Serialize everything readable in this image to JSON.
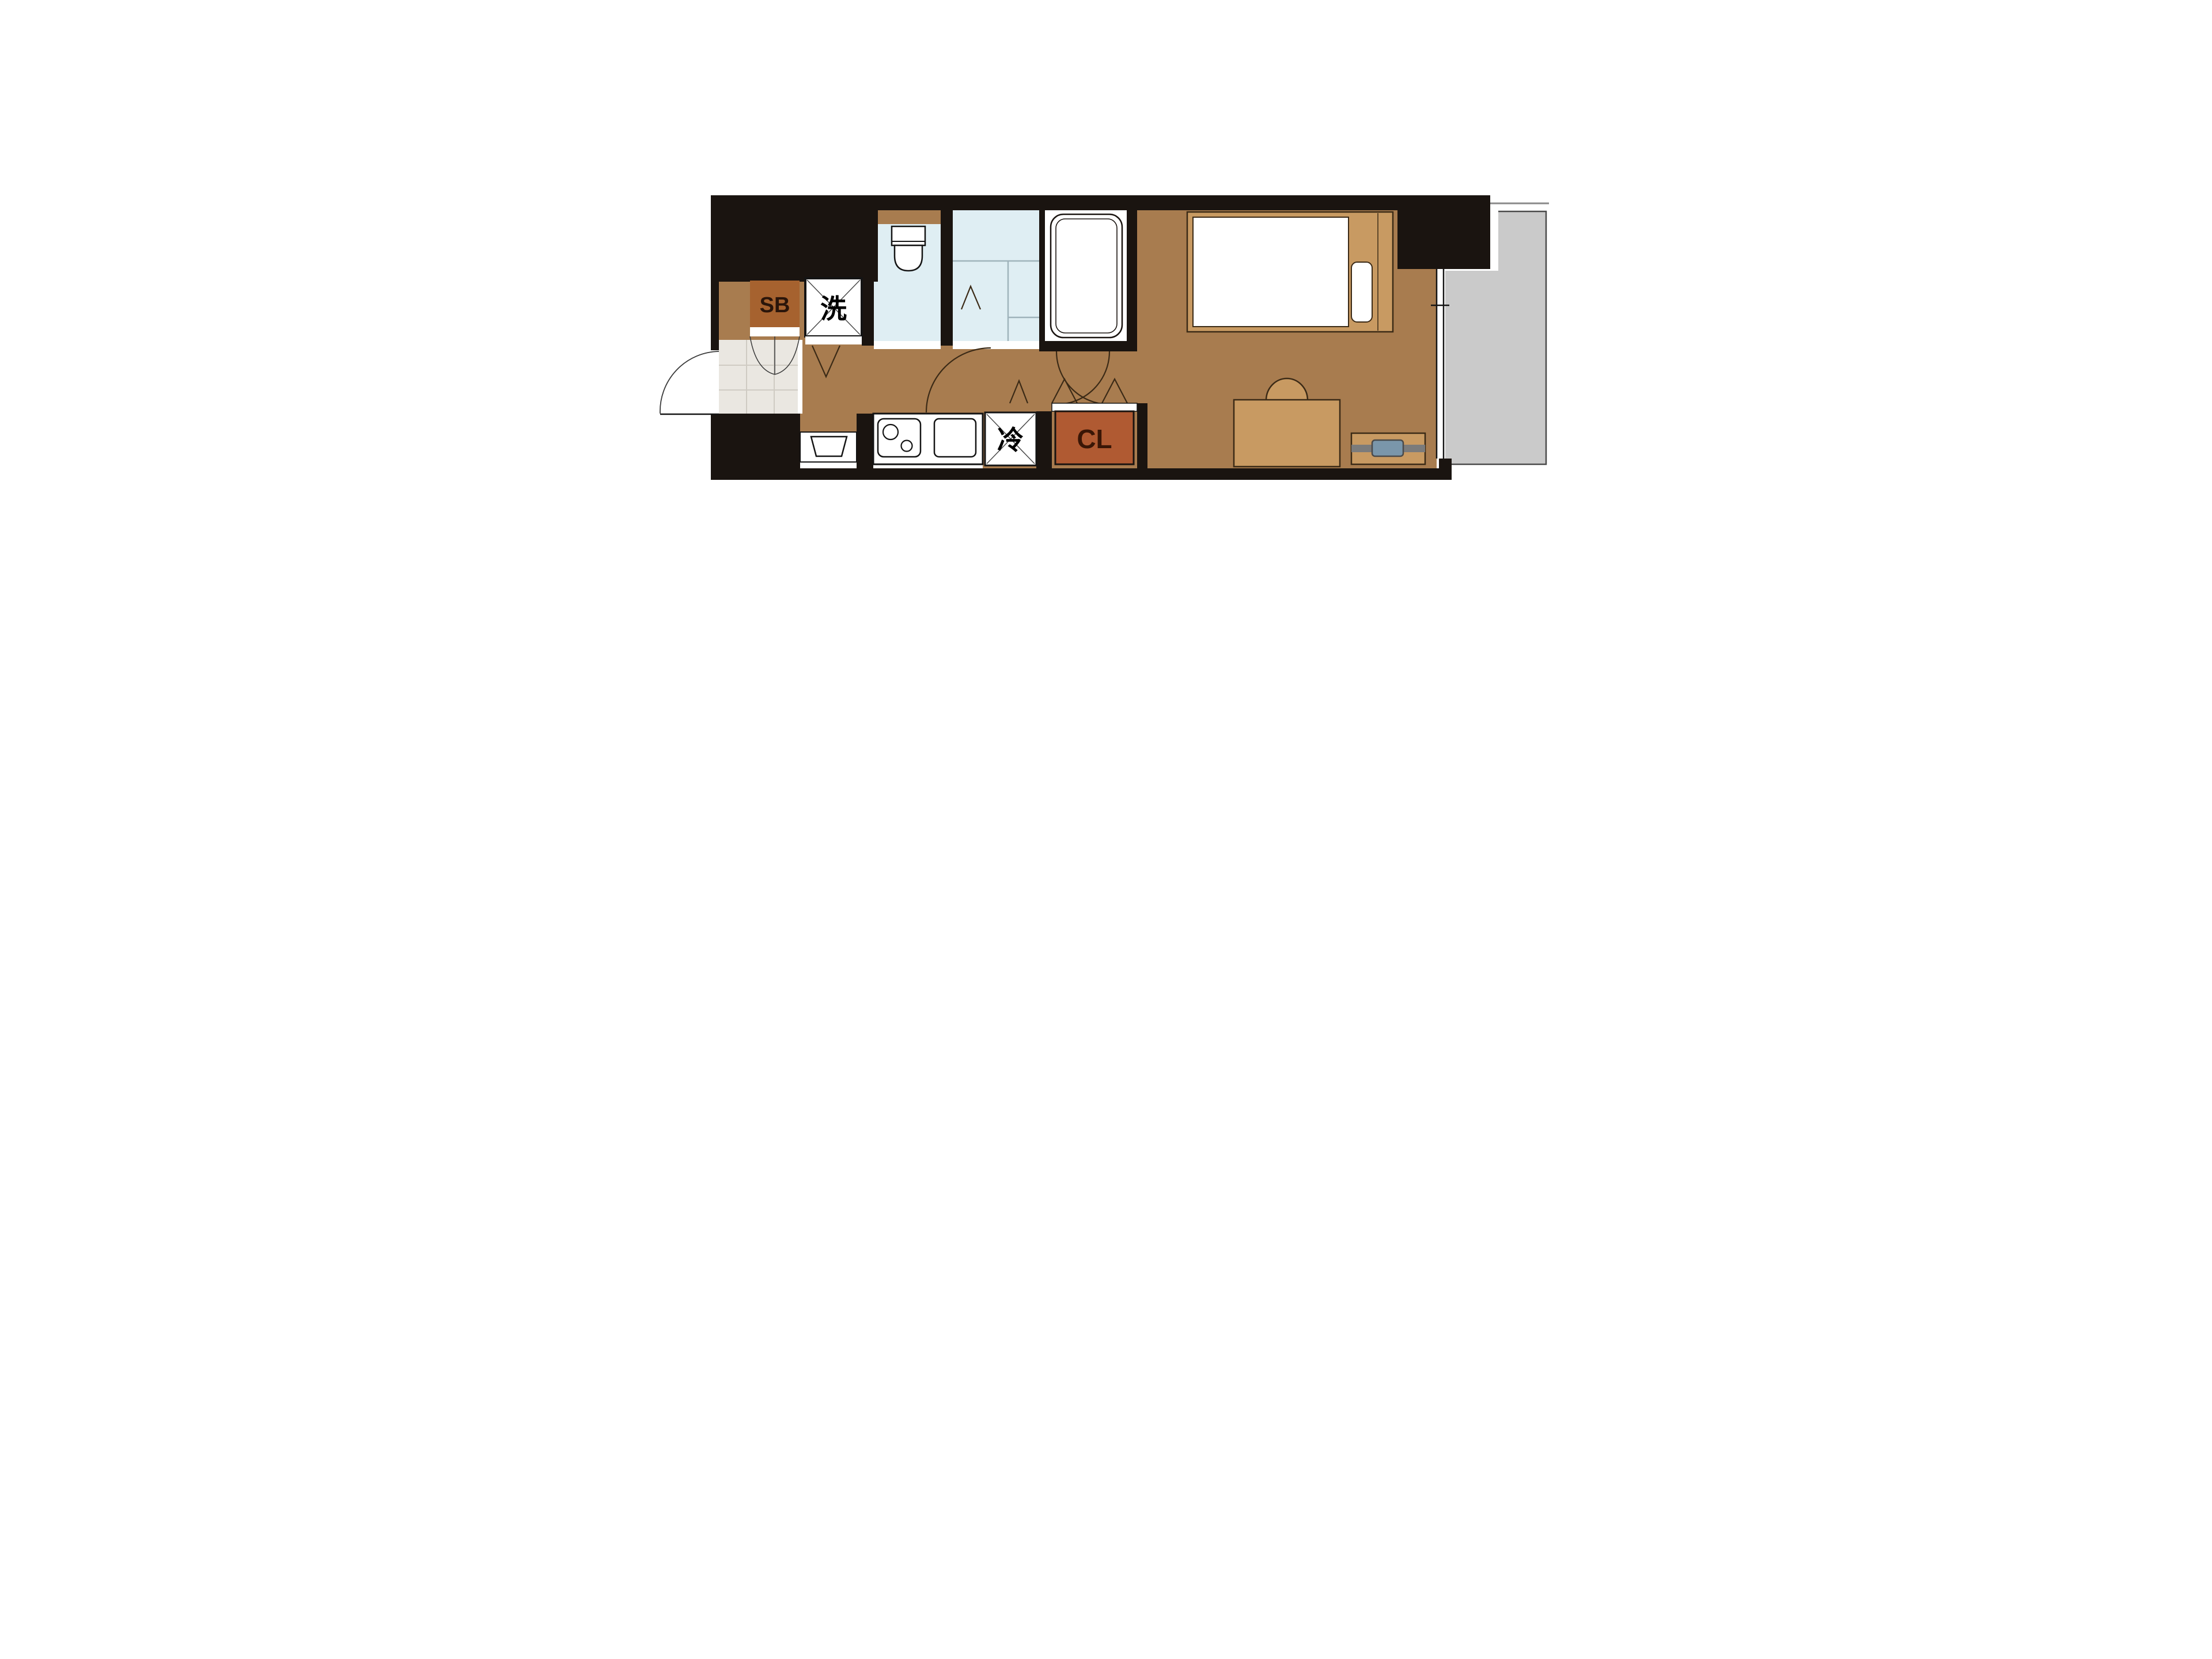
{
  "plan": {
    "type": "apartment-floor-plan",
    "labels": {
      "shoe_box": "SB",
      "washing_machine": "洗",
      "refrigerator": "冷",
      "closet": "CL"
    },
    "colors": {
      "wall": "#1a1410",
      "floor": "#a87c4f",
      "wet_room_floor": "#dfeef3",
      "entrance_floor": "#eae7e1",
      "balcony_floor": "#cacaca",
      "furniture": "#c89a62",
      "shoe_box": "#a6622f",
      "closet": "#b05a32",
      "tv": "#7a96aa",
      "fixture_white": "#ffffff",
      "door_line": "#3b2a16"
    },
    "fixtures": [
      "entrance-door",
      "shoe-box",
      "washing-machine-pan",
      "toilet",
      "vanity-counter",
      "bathtub",
      "kitchen-counter",
      "two-burner-stove",
      "kitchen-sink",
      "wash-basin",
      "refrigerator",
      "closet",
      "bed",
      "mattress",
      "pillow",
      "desk",
      "chair",
      "tv-board",
      "tv",
      "sliding-window",
      "balcony"
    ]
  }
}
